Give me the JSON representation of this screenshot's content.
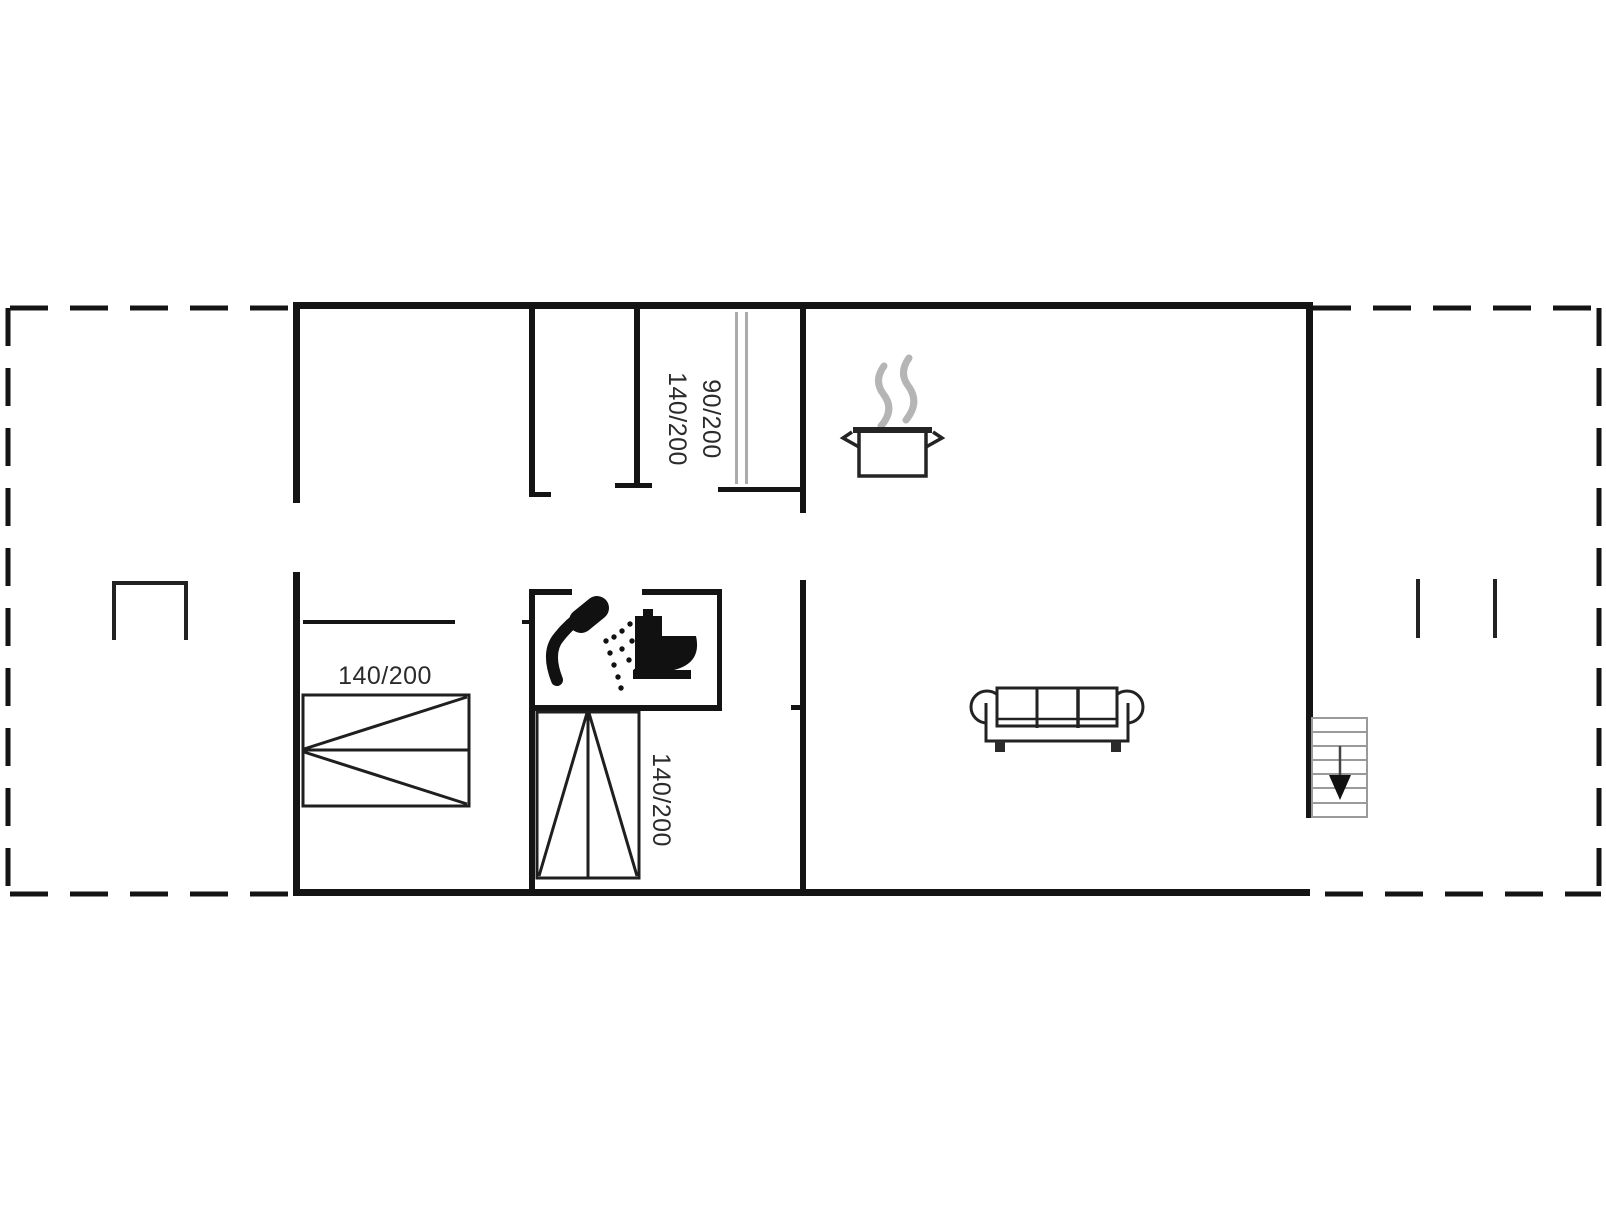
{
  "floorplan": {
    "type": "vacation-house-floor-plan",
    "labels": {
      "hall_line1": "90/200",
      "hall_line2": "140/200",
      "bed_left": "140/200",
      "bed_middle": "140/200"
    },
    "colors": {
      "wall": "#141414",
      "furniture_line": "#1f1f1f",
      "stairs_gray": "#9a9a9a",
      "wardrobe_gray": "#ababab",
      "steam_gray": "#b5b5b5",
      "text": "#2b2b2b",
      "background": "#ffffff"
    },
    "icons": [
      "cooking-pot-icon",
      "steam-icon",
      "shower-icon",
      "toilet-icon",
      "sofa-icon",
      "stairs-icon",
      "arrow-down-icon"
    ]
  }
}
